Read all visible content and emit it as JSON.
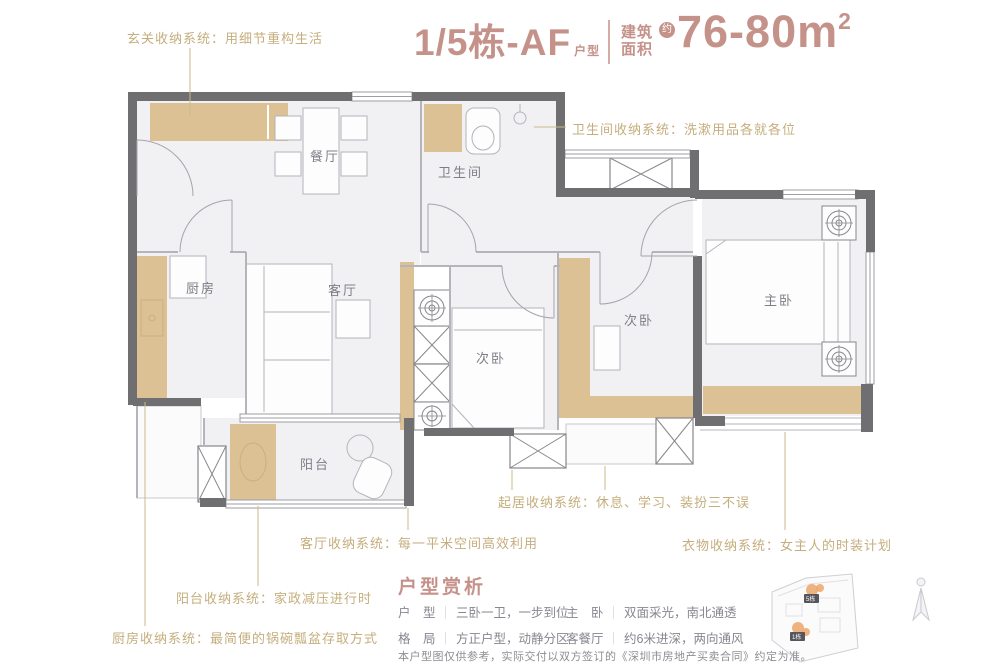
{
  "header": {
    "unit_title": "1/5栋-AF",
    "unit_suffix": "户型",
    "area_label_top": "建筑",
    "area_label_bottom": "面积",
    "approx_badge": "约",
    "area_value": "76-80m",
    "area_exponent": "2"
  },
  "annotations": {
    "entry": "玄关收纳系统：用细节重构生活",
    "bathroom": "卫生间收纳系统：洗漱用品各就各位",
    "daily": "起居收纳系统：休息、学习、装扮三不误",
    "living": "客厅收纳系统：每一平米空间高效利用",
    "clothes": "衣物收纳系统：女主人的时装计划",
    "balcony": "阳台收纳系统：家政减压进行时",
    "kitchen": "厨房收纳系统：最简便的锅碗瓢盆存取方式"
  },
  "rooms": {
    "dining": "餐厅",
    "bathroom": "卫生间",
    "kitchen": "厨房",
    "living": "客厅",
    "bedroom_mid": "次卧",
    "bedroom_right": "次卧",
    "master": "主卧",
    "balcony": "阳台"
  },
  "analysis": {
    "heading": "户型赏析",
    "separator": "｜",
    "items": [
      {
        "label": "户　型",
        "value": "三卧一卫，一步到位"
      },
      {
        "label": "主　卧",
        "value": "双面采光，南北通透"
      },
      {
        "label": "格　局",
        "value": "方正户型，动静分区"
      },
      {
        "label": "客餐厅",
        "value": "约6米进深，两向通风"
      }
    ],
    "disclaimer": "本户型图仅供参考，实际交付以双方签订的《深圳市房地产买卖合同》约定为准。"
  },
  "keyplan": {
    "building_top": "5栋",
    "building_bottom": "1栋"
  },
  "colors": {
    "accent": "#c5928a",
    "annotation": "#c4ae7d",
    "wall": "#6f6f72",
    "furniture": "#dcc195"
  }
}
